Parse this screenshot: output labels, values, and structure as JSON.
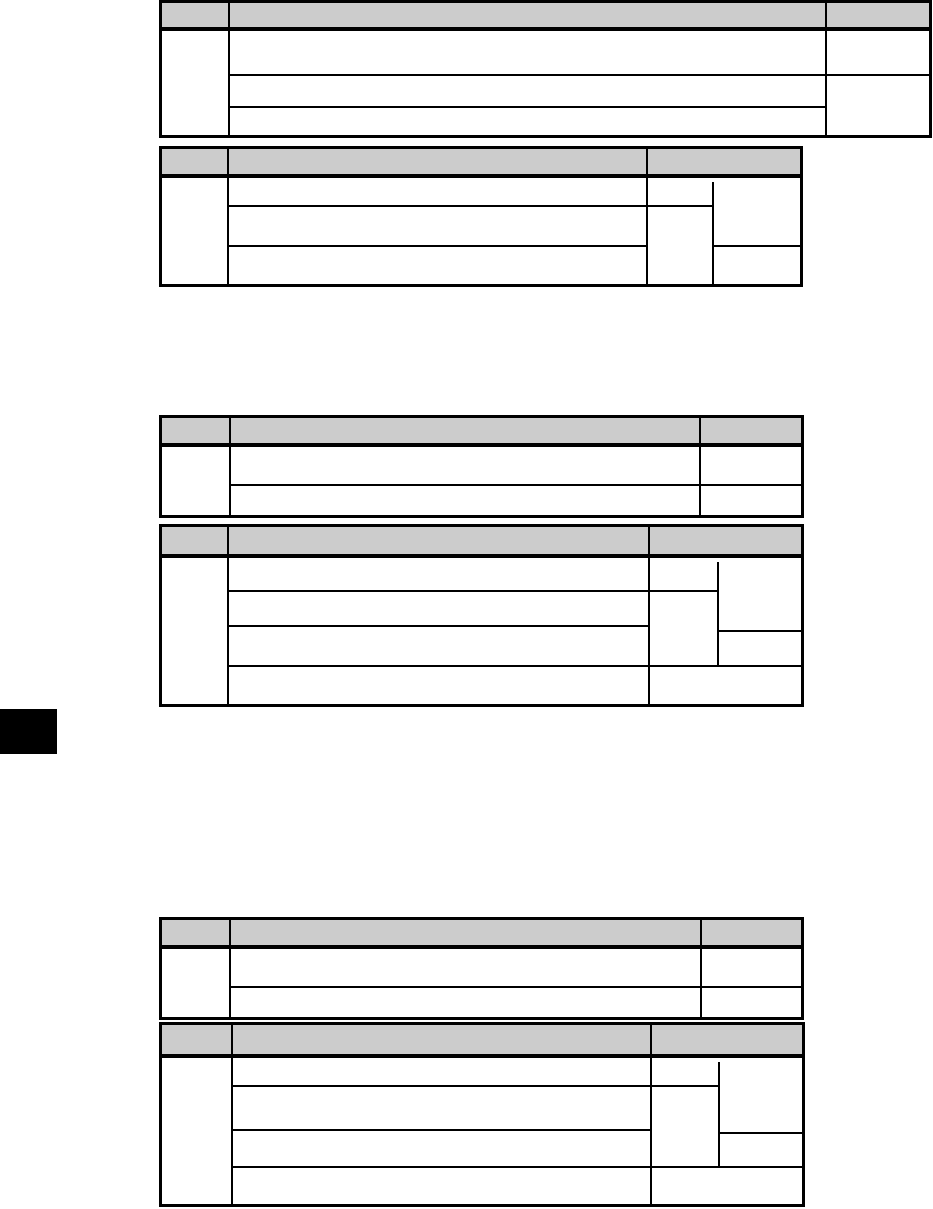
{
  "page": {
    "width": 933,
    "height": 1209,
    "background": "#ffffff"
  },
  "colors": {
    "line": "#000000",
    "header_fill": "#cccccc",
    "tab_fill": "#000000",
    "cell_fill": "#ffffff"
  },
  "chapter_tab": {
    "x": 0,
    "y": 709,
    "w": 57,
    "h": 45
  },
  "line_style": {
    "outer_border": 3,
    "header_rule": 4,
    "inner_rule": 2
  },
  "tables": [
    {
      "name": "table-1",
      "frame": {
        "x": 159,
        "y": 0,
        "w": 773,
        "h": 138
      },
      "header": {
        "top": 3,
        "height": 28
      },
      "v_lines": [
        {
          "x": 229,
          "y1": 3,
          "y2": 135
        },
        {
          "x": 826,
          "y1": 3,
          "y2": 135
        }
      ],
      "h_lines": [
        {
          "y": 75,
          "x1": 229,
          "x2": 929
        },
        {
          "y": 107,
          "x1": 229,
          "x2": 826
        }
      ]
    },
    {
      "name": "table-2",
      "frame": {
        "x": 159,
        "y": 146,
        "w": 644,
        "h": 141
      },
      "header": {
        "top": 149,
        "height": 29
      },
      "v_lines": [
        {
          "x": 228,
          "y1": 149,
          "y2": 284
        },
        {
          "x": 647,
          "y1": 149,
          "y2": 284
        },
        {
          "x": 713,
          "y1": 182,
          "y2": 284
        }
      ],
      "h_lines": [
        {
          "y": 206,
          "x1": 228,
          "x2": 713
        },
        {
          "y": 246,
          "x1": 228,
          "x2": 647
        },
        {
          "y": 246,
          "x1": 713,
          "x2": 800
        }
      ]
    },
    {
      "name": "table-3",
      "frame": {
        "x": 159,
        "y": 415,
        "w": 645,
        "h": 103
      },
      "header": {
        "top": 418,
        "height": 29
      },
      "v_lines": [
        {
          "x": 230,
          "y1": 418,
          "y2": 515
        },
        {
          "x": 700,
          "y1": 418,
          "y2": 515
        }
      ],
      "h_lines": [
        {
          "y": 485,
          "x1": 230,
          "x2": 801
        }
      ]
    },
    {
      "name": "table-4",
      "frame": {
        "x": 159,
        "y": 524,
        "w": 645,
        "h": 183
      },
      "header": {
        "top": 527,
        "height": 31
      },
      "v_lines": [
        {
          "x": 228,
          "y1": 527,
          "y2": 704
        },
        {
          "x": 649,
          "y1": 527,
          "y2": 704
        },
        {
          "x": 718,
          "y1": 562,
          "y2": 666
        }
      ],
      "h_lines": [
        {
          "y": 591,
          "x1": 228,
          "x2": 718
        },
        {
          "y": 626,
          "x1": 228,
          "x2": 649
        },
        {
          "y": 631,
          "x1": 718,
          "x2": 801
        },
        {
          "y": 666,
          "x1": 228,
          "x2": 801
        }
      ]
    },
    {
      "name": "table-5",
      "frame": {
        "x": 159,
        "y": 917,
        "w": 645,
        "h": 103
      },
      "header": {
        "top": 920,
        "height": 29
      },
      "v_lines": [
        {
          "x": 230,
          "y1": 920,
          "y2": 1017
        },
        {
          "x": 701,
          "y1": 920,
          "y2": 1017
        }
      ],
      "h_lines": [
        {
          "y": 987,
          "x1": 230,
          "x2": 801
        }
      ]
    },
    {
      "name": "table-6",
      "frame": {
        "x": 159,
        "y": 1022,
        "w": 646,
        "h": 185
      },
      "header": {
        "top": 1025,
        "height": 33
      },
      "v_lines": [
        {
          "x": 232,
          "y1": 1025,
          "y2": 1204
        },
        {
          "x": 651,
          "y1": 1025,
          "y2": 1204
        },
        {
          "x": 719,
          "y1": 1062,
          "y2": 1167
        }
      ],
      "h_lines": [
        {
          "y": 1086,
          "x1": 232,
          "x2": 719
        },
        {
          "y": 1130,
          "x1": 232,
          "x2": 651
        },
        {
          "y": 1133,
          "x1": 719,
          "x2": 802
        },
        {
          "y": 1167,
          "x1": 232,
          "x2": 802
        }
      ]
    }
  ]
}
